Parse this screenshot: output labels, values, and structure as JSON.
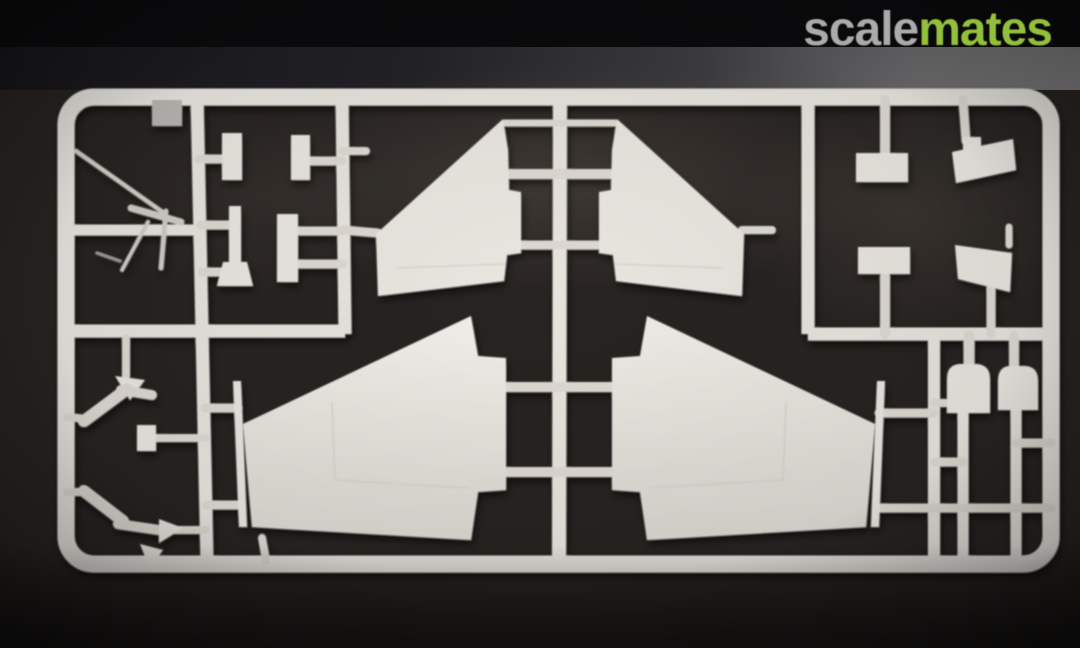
{
  "watermark": {
    "scale_text": "scale",
    "mates_text": "mates",
    "scale_color": "#ababab",
    "mates_color": "#93c03c"
  },
  "colors": {
    "background_top": "#0b0a0c",
    "mat": "#272321",
    "band_left": "#17161a",
    "band_right": "#7a797b",
    "plastic_runner": "#e7e4de",
    "plastic_part": "#e9e6e0",
    "plastic_dim": "#b7b4b0",
    "plastic_thin": "#cfccc6",
    "wing_highlight": "#f1efe9",
    "wing_shadow": "#dbd8d1",
    "shadow": "#000000"
  },
  "scene": {
    "description": "White plastic model kit sprue with aircraft wing, tailplane and small detail parts photographed on a dark mat",
    "parts": [
      "outer-frame",
      "center-runner",
      "left-runner",
      "left-divider-runner",
      "subframe-left-runner",
      "right-lower-runner",
      "left-cell-divider",
      "subframe-bottom-runner",
      "antenna-crossbar",
      "square-part",
      "antenna-part",
      "rect-part-a",
      "rect-part-b",
      "pylon-part",
      "rect-part-c",
      "upper-tailplane-left",
      "upper-tailplane-right",
      "lower-wing-left",
      "lower-wing-right",
      "gear-leg-upper",
      "gear-leg-lower",
      "clip-part",
      "arrowhead-part",
      "arrowhead-part-lower",
      "subframe-rect-top",
      "subframe-angled-top",
      "subframe-rect-bottom",
      "subframe-angled-bottom",
      "dome-part-left",
      "dome-part-right"
    ]
  }
}
